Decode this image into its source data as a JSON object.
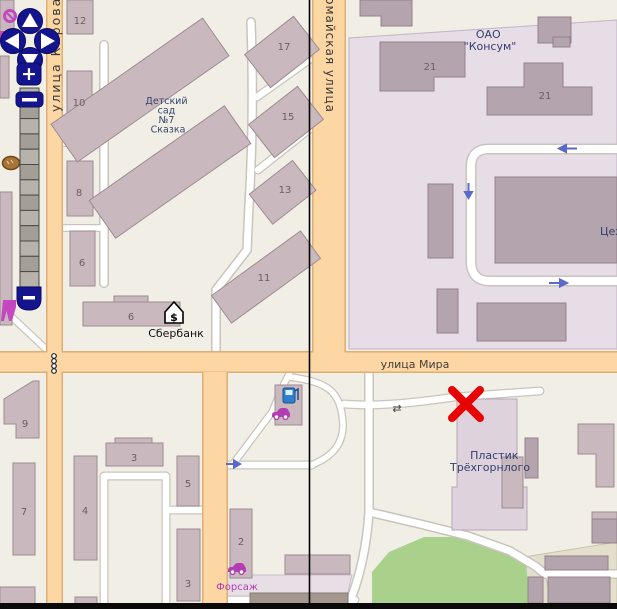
{
  "colors": {
    "marker_x": "#e60404",
    "road_main_orange": "#fcd7a3",
    "industrial_area": "#e7dde7",
    "industrial_area_khaki": "#e4dfcd",
    "grass_area": "#a9d18c",
    "building_fill": "#c9b9be",
    "oneway_arrow": "#5a68cc",
    "nav_control_blue": "#14148f",
    "poi_magenta": "#b33db3"
  },
  "controls": {
    "zoom_in_label": "+",
    "zoom_out_label": "−"
  },
  "icons": {
    "pan_up": "▲",
    "pan_down": "▼",
    "pan_left": "◀",
    "pan_right": "▶",
    "bank_symbol": "$",
    "gate_symbol": "⇄"
  },
  "map": {
    "street_labels": {
      "kirova": "улица Кирова",
      "pervomayskaya": "Первомайская улица",
      "mira": "улица Мира"
    },
    "place_labels": {
      "kindergarten": [
        "Детский",
        "сад",
        "№7",
        "Сказка"
      ],
      "konsum": [
        "ОАО",
        "\"Консум\""
      ],
      "tsekh": "Цех",
      "sberbank": "Сбербанк",
      "plastik": [
        "Пластик",
        "Трёхгорнлого"
      ],
      "forsazh": "Форсаж"
    },
    "house_numbers": {
      "n12": "12",
      "n10": "10",
      "n8": "8",
      "n6a": "6",
      "n6b": "6",
      "n11": "11",
      "n17": "17",
      "n15": "15",
      "n13": "13",
      "n21a": "21",
      "n21b": "21",
      "n9": "9",
      "n7": "7",
      "n4": "4",
      "n3a": "3",
      "n5": "5",
      "n3b": "3",
      "n2": "2"
    }
  }
}
